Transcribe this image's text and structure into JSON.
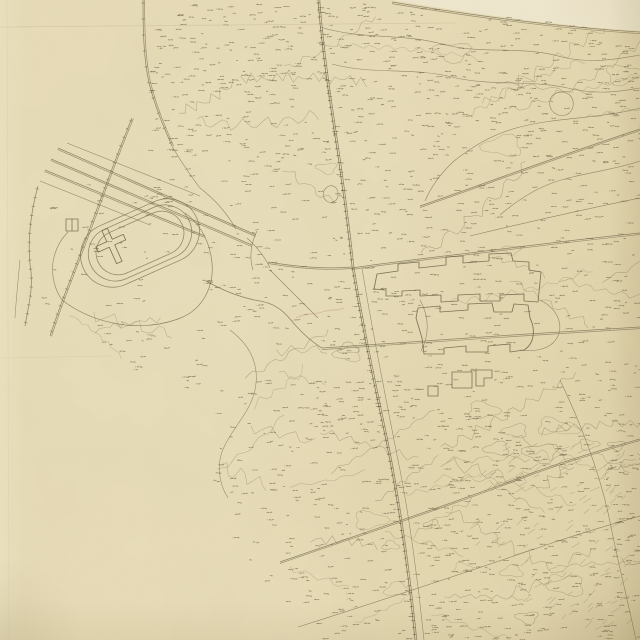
{
  "meta": {
    "kind": "scanned hand-drawn topographic survey map",
    "legible_text": [],
    "annotations_note": "hundreds of tiny spot-height numerals, illegible at this resolution"
  },
  "palette": {
    "paper": "#e8ddb8",
    "paper_light": "#efe7cd",
    "paper_mid": "#e3d7af",
    "paper_shadow": "#d9cca3",
    "ink": "#7b7054",
    "ink_dark": "#645a40",
    "ink_faint": "#968a6b",
    "spot_ink": "#5e543a",
    "crease": "#c6ba92",
    "faded_annotation": "#c9a08e"
  },
  "canvas": {
    "width": 640,
    "height": 640,
    "seed": 11
  },
  "stadium": {
    "cx": 140,
    "cy": 243,
    "rot": -24,
    "rings": [
      [
        30,
        32
      ],
      [
        27,
        27
      ],
      [
        24,
        22
      ]
    ]
  },
  "features": [
    {
      "name": "neatline-upper-paper",
      "d": "M392,0 C470,13 556,26 640,31 L640,0 Z",
      "fill": "#eee6cd"
    },
    {
      "name": "neatline-road",
      "d": "M392,2 C470,15 556,27 640,32",
      "off": [
        0,
        1.6
      ],
      "w": 0.7
    },
    {
      "name": "top-vertical-road",
      "d": "M143,0 C143,34 144,60 149,83 C156,110 165,130 172,146",
      "off": [
        1.6,
        0
      ],
      "ticks": 16
    },
    {
      "name": "top-vertical-road-ext",
      "d": "M172,146 C181,162 191,176 200,188",
      "w": 0.6
    },
    {
      "name": "railway-north",
      "d": "M318,0 C322,52 330,104 338,156 C344,198 349,238 352,266",
      "off": [
        1.8,
        0
      ],
      "ticks": 7,
      "dark": true
    },
    {
      "name": "railway-south",
      "d": "M352,266 C360,316 371,370 383,426 C395,482 407,558 415,640",
      "off": [
        1.8,
        0
      ],
      "ticks": 7,
      "dark": true
    },
    {
      "name": "road-parallel-south",
      "d": "M362,268 C372,330 388,410 400,470 C409,516 418,580 424,640",
      "w": 0.55
    },
    {
      "name": "long-diagonal-road-1",
      "d": "M280,562 C360,534 452,504 532,473 C568,460 604,449 640,439",
      "off": [
        0,
        1.5
      ]
    },
    {
      "name": "long-diagonal-road-2",
      "d": "M298,627 C380,601 470,571 558,541 C588,531 616,523 640,516",
      "w": 0.6
    },
    {
      "name": "boulevard-fan-1",
      "d": "M58,148 L256,235",
      "off": [
        -0.5,
        1.4
      ]
    },
    {
      "name": "boulevard-fan-2",
      "d": "M51,159 L252,245",
      "off": [
        -0.5,
        1.4
      ]
    },
    {
      "name": "boulevard-fan-3",
      "d": "M45,170 L205,236",
      "off": [
        -0.5,
        1.4
      ]
    },
    {
      "name": "boulevard-fan-4",
      "d": "M40,181 L150,225",
      "w": 0.6
    },
    {
      "name": "boulevard-fan-5",
      "d": "M67,143 L200,196",
      "w": 0.55
    },
    {
      "name": "left-tick-road",
      "d": "M132,118 C112,166 92,224 71,278 C63,298 56,318 50,336",
      "off": [
        1.4,
        0.6
      ],
      "ticks": 9
    },
    {
      "name": "left-boundary-road",
      "d": "M38,186 C30,214 27,246 31,272 C33,290 28,308 25,326",
      "ticks": 9
    },
    {
      "name": "left-boundary-road-outer",
      "d": "M20,260 C18,282 16,300 15,318",
      "w": 0.55
    },
    {
      "name": "oval-outer-loop",
      "d": "M62,300 C96,326 142,332 178,319 C206,309 216,281 211,256 C208,238 198,222 185,213",
      "w": 0.7
    },
    {
      "name": "oval-outer-loop-west",
      "d": "M62,300 C55,290 51,276 53,262 C55,250 60,240 68,232",
      "w": 0.6
    },
    {
      "name": "oval-exit-southeast",
      "d": "M206,281 C226,292 242,298 260,301 C272,303 282,309 290,319"
    },
    {
      "name": "exit-continuation",
      "d": "M290,319 C300,331 310,341 322,348"
    },
    {
      "name": "junction-curve-a",
      "d": "M247,238 C257,247 265,257 270,268",
      "w": 0.6
    },
    {
      "name": "junction-curve-b",
      "d": "M257,231 C251,243 249,257 253,270",
      "w": 0.6
    },
    {
      "name": "junction-east-road",
      "d": "M268,262 C298,267 328,269 352,267",
      "off": [
        0,
        1.5
      ]
    },
    {
      "name": "junction-southeast-road",
      "d": "M270,270 C289,289 304,304 318,318",
      "w": 0.6
    },
    {
      "name": "eastwest-road-north",
      "d": "M352,268 C398,261 446,256 494,250 C542,244 592,238 640,233",
      "off": [
        0,
        1.5
      ]
    },
    {
      "name": "northeast-road-1",
      "d": "M420,206 C478,186 558,156 640,129",
      "off": [
        0,
        1.5
      ]
    },
    {
      "name": "northeast-road-2",
      "d": "M470,236 C528,222 586,209 640,198",
      "w": 0.6
    },
    {
      "name": "eastwest-road-mid",
      "d": "M322,348 C424,341 536,333 640,327",
      "off": [
        0,
        1.6
      ]
    },
    {
      "name": "building-drive-west",
      "d": "M420,300 C430,318 429,336 421,351",
      "w": 0.6
    },
    {
      "name": "building-drive-east",
      "d": "M540,300 C560,310 566,330 553,343 C545,350 532,352 520,350",
      "w": 0.6
    },
    {
      "name": "top-meander-road-1",
      "d": "M320,27 C362,40 402,33 442,44 C482,55 522,45 562,57 C592,64 618,59 640,55",
      "w": 0.6
    },
    {
      "name": "top-meander-road-2",
      "d": "M332,64 C372,75 412,67 452,77 C492,87 532,79 572,89 C600,95 622,91 640,88",
      "w": 0.55
    },
    {
      "name": "pond-east",
      "d": "M552,96 C560,89 571,92 573,101 C575,111 566,119 556,114 C549,110 548,102 552,96 Z",
      "w": 0.6
    },
    {
      "name": "pond-center",
      "d": "M326,188 C332,183 339,187 338,196 C337,203 328,205 324,198 C323,193 323,191 326,188 Z",
      "w": 0.6
    },
    {
      "name": "right-curvy-road-1",
      "d": "M640,108 C600,119 558,117 520,127 C492,134 472,147 454,161",
      "w": 0.6
    },
    {
      "name": "right-curvy-road-2",
      "d": "M454,161 C441,173 431,187 425,201",
      "w": 0.6
    },
    {
      "name": "right-curvy-road-3",
      "d": "M640,161 C610,171 580,173 552,183 C531,191 514,203 500,215",
      "w": 0.6
    },
    {
      "name": "stream-southeast",
      "d": "M560,380 C580,422 600,472 610,522 C618,562 628,602 636,640",
      "w": 0.6
    },
    {
      "name": "oval-connector-road",
      "d": "M200,188 C217,201 228,215 236,229",
      "w": 0.6
    },
    {
      "name": "contour-major-bottomleft",
      "d": "M230,330 C250,345 260,365 255,390 C250,412 235,425 225,445 C216,462 218,482 228,498",
      "w": 0.55
    },
    {
      "name": "main-building-stepped",
      "d": "M374,289 L377,274 L398,271 L398,264 L419,262 L419,268 L446,265 L446,257 L463,256 L463,263 L489,261 L489,254 L511,253 L513,261 L529,262 L529,270 L541,272 L538,302 L524,301 L524,294 L500,295 L500,301 L480,301 L480,294 L458,295 L458,301 L441,302 L441,295 L420,296 L420,290 L402,291 L402,296 L386,296 L386,290 Z",
      "dark": true,
      "w": 0.85
    },
    {
      "name": "south-building-stepped",
      "d": "M416,318 L418,308 L440,306 L440,312 L468,310 L468,304 L492,303 L494,312 L512,312 L514,304 L528,305 L530,318 C536,330 534,344 524,350 L510,352 L510,344 L488,346 L488,352 L466,352 L466,346 L444,348 L444,354 L424,354 L422,338 Z",
      "dark": true,
      "w": 0.85
    },
    {
      "name": "outbuilding-1",
      "d": "M452,372 L472,372 L472,388 L452,388 Z",
      "dark": true,
      "w": 0.8
    },
    {
      "name": "outbuilding-2",
      "d": "M476,370 L492,370 L492,378 L484,378 L484,386 L476,386 Z",
      "dark": true,
      "w": 0.8
    },
    {
      "name": "outbuilding-3",
      "d": "M428,386 L438,386 L438,396 L428,396 Z",
      "dark": true,
      "w": 0.8
    },
    {
      "name": "small-square-structure",
      "d": "M66,219 L78,219 L78,231 L66,231 Z M72,219 L72,231",
      "dark": true,
      "w": 0.8
    },
    {
      "name": "cross-shaped-building",
      "d": "M109,228 L115,228 L115,240 L127,240 L127,246 L115,246 L115,264 L109,264 L109,246 L97,246 L97,240 L109,240 Z",
      "transform": "rotate(-24 112 246)",
      "dark": true,
      "w": 0.85
    },
    {
      "name": "faded-annotation",
      "d": "M296,318 C304,313 314,315 322,312 C330,309 338,311 344,308",
      "stroke": "#c9a08e",
      "w": 1.2,
      "op": 0.45
    }
  ],
  "creases": [
    {
      "name": "crease-top",
      "d": "M0,27 L456,23",
      "op": 0.5
    },
    {
      "name": "crease-left",
      "d": "M7,0 L9,640",
      "op": 0.25
    },
    {
      "name": "crease-mid",
      "d": "M0,358 L112,356",
      "op": 0.28
    }
  ],
  "spot_regions": [
    {
      "x": 150,
      "y": 4,
      "w": 490,
      "h": 80,
      "count": 330
    },
    {
      "x": 150,
      "y": 84,
      "w": 490,
      "h": 80,
      "count": 260
    },
    {
      "x": 330,
      "y": 164,
      "w": 310,
      "h": 90,
      "count": 150
    },
    {
      "x": 150,
      "y": 164,
      "w": 180,
      "h": 90,
      "count": 60
    },
    {
      "x": 40,
      "y": 150,
      "w": 110,
      "h": 200,
      "count": 45
    },
    {
      "x": 200,
      "y": 254,
      "w": 140,
      "h": 90,
      "count": 55
    },
    {
      "x": 330,
      "y": 254,
      "w": 310,
      "h": 90,
      "count": 130
    },
    {
      "x": 300,
      "y": 344,
      "w": 340,
      "h": 100,
      "count": 170
    },
    {
      "x": 420,
      "y": 444,
      "w": 220,
      "h": 196,
      "count": 330
    },
    {
      "x": 210,
      "y": 380,
      "w": 210,
      "h": 130,
      "count": 120
    },
    {
      "x": 230,
      "y": 510,
      "w": 190,
      "h": 130,
      "count": 110
    },
    {
      "x": 90,
      "y": 330,
      "w": 120,
      "h": 60,
      "count": 25
    }
  ],
  "squiggle_regions": [
    {
      "x": 330,
      "y": 36,
      "w": 300,
      "h": 130,
      "count": 10,
      "len": [
        80,
        200
      ]
    },
    {
      "x": 180,
      "y": 60,
      "w": 160,
      "h": 110,
      "count": 6,
      "len": [
        50,
        130
      ]
    },
    {
      "x": 420,
      "y": 170,
      "w": 220,
      "h": 150,
      "count": 7,
      "len": [
        60,
        150
      ]
    },
    {
      "x": 200,
      "y": 330,
      "w": 200,
      "h": 150,
      "count": 10,
      "len": [
        40,
        120
      ]
    },
    {
      "x": 230,
      "y": 470,
      "w": 200,
      "h": 160,
      "count": 12,
      "len": [
        40,
        130
      ]
    },
    {
      "x": 430,
      "y": 380,
      "w": 210,
      "h": 250,
      "count": 22,
      "len": [
        50,
        160
      ]
    },
    {
      "x": 500,
      "y": 430,
      "w": 140,
      "h": 130,
      "count": 14,
      "len": [
        20,
        60
      ]
    },
    {
      "x": 60,
      "y": 300,
      "w": 160,
      "h": 60,
      "count": 5,
      "len": [
        40,
        100
      ]
    }
  ],
  "hatch_regions": [
    {
      "x": 470,
      "y": 445,
      "w": 160,
      "h": 110,
      "count": 70
    },
    {
      "x": 520,
      "y": 560,
      "w": 110,
      "h": 70,
      "count": 40
    }
  ]
}
